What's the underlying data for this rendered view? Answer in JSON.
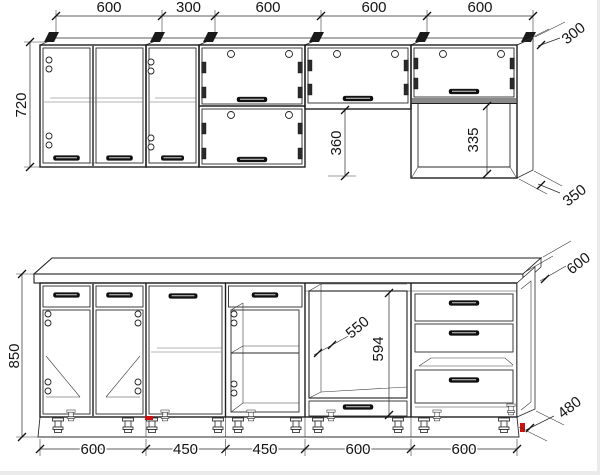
{
  "drawing": {
    "name": "kitchen-set-assembly-drawing",
    "units": "mm",
    "colors": {
      "line": "#1f1f1f",
      "accent": "#cc1111",
      "background": "#ffffff"
    },
    "upper_row": {
      "widths": [
        "600",
        "300",
        "600",
        "600",
        "600"
      ],
      "height": "720",
      "cabinet_depth": "300",
      "gap_below_short_cabinet": "360",
      "open_shelf_height": "335",
      "open_shelf_depth": "350"
    },
    "lower_row": {
      "widths": [
        "600",
        "450",
        "450",
        "600",
        "600"
      ],
      "height": "850",
      "worktop_depth": "600",
      "oven_niche_width": "550",
      "oven_niche_height": "594",
      "base_depth": "480"
    }
  }
}
